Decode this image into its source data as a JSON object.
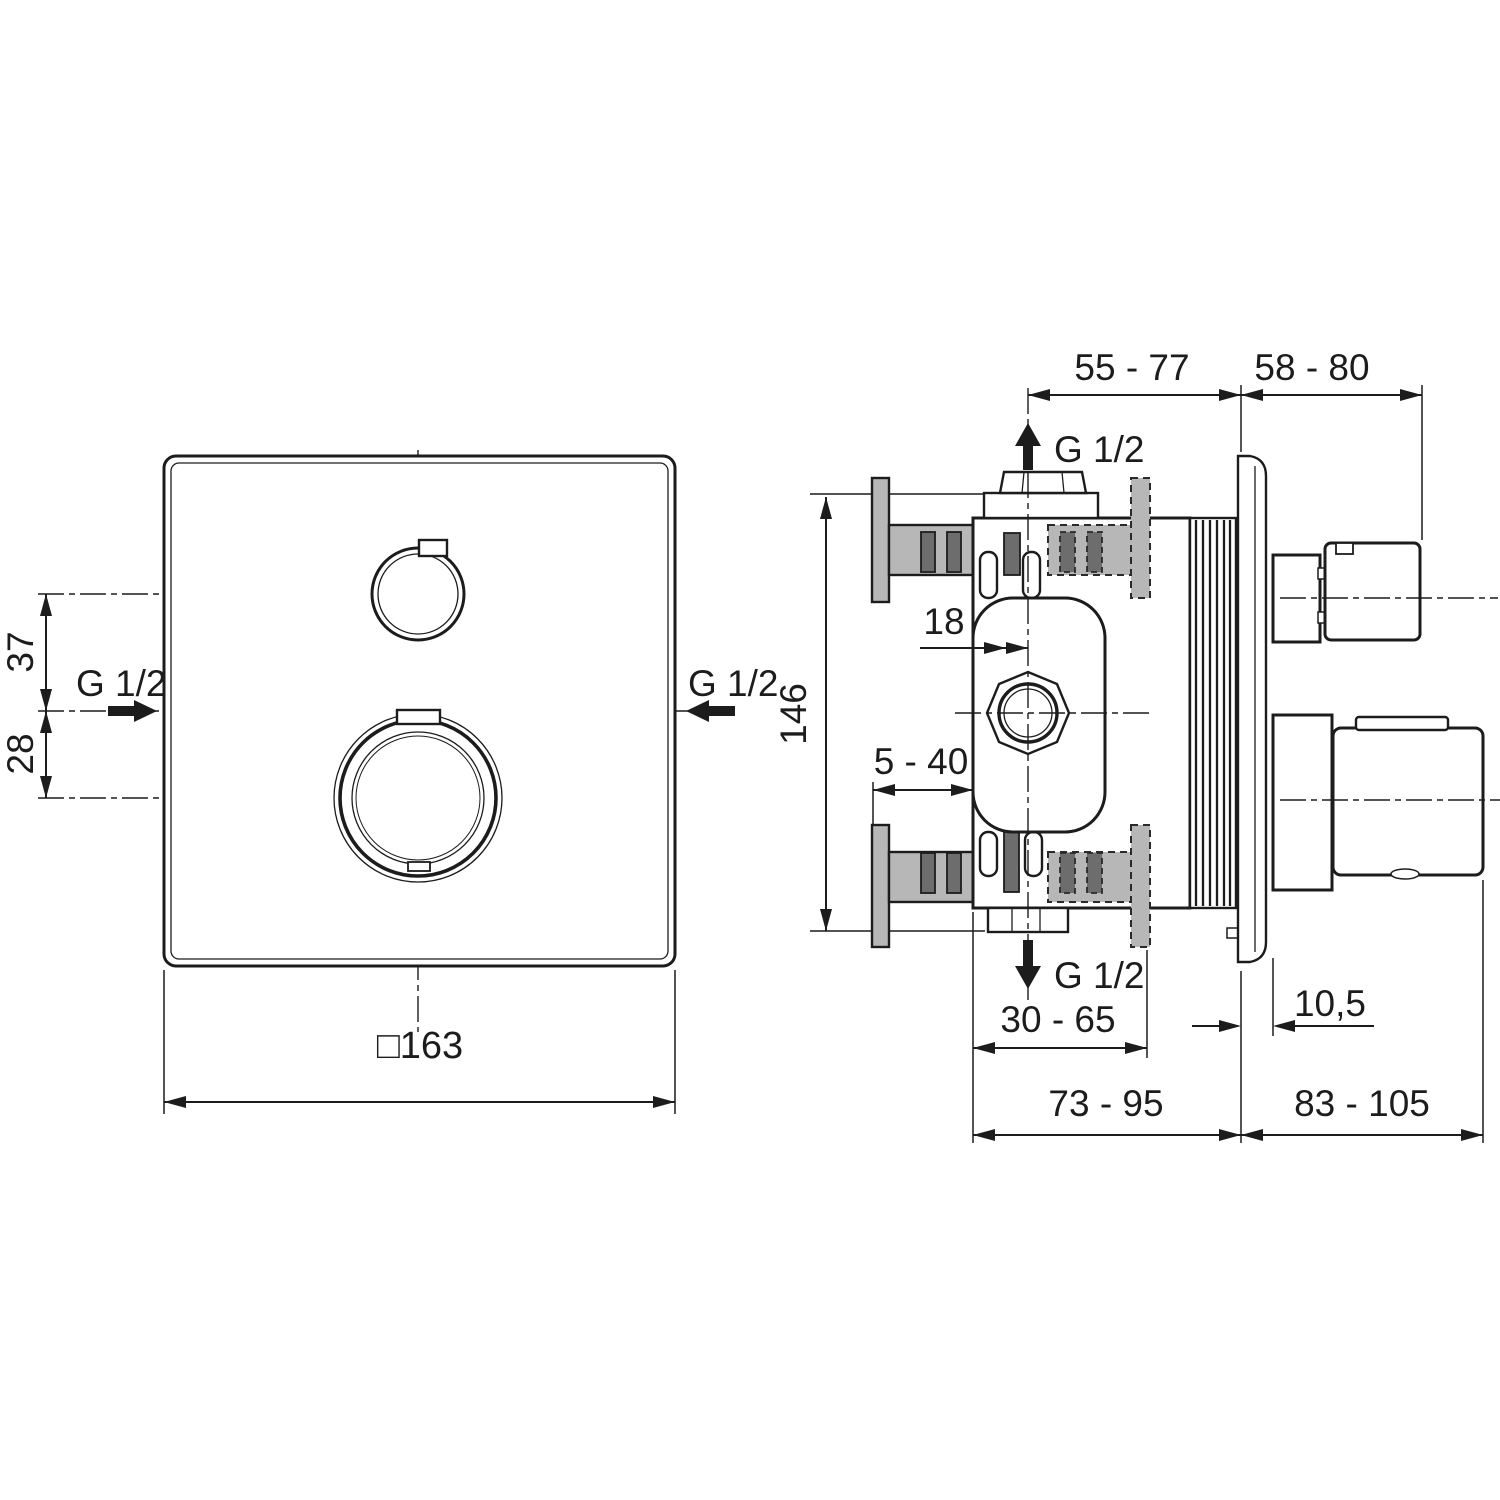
{
  "page": {
    "background": "#ffffff",
    "line_color": "#1c1c1c",
    "bracket_fill": "#b7b7b7",
    "slot_fill": "#6d6d6d"
  },
  "front_view": {
    "plate_width_label": "□163",
    "upper_knob_offset_label": "37",
    "inlet_offset_label": "28",
    "left_inlet_label": "G 1/2",
    "right_inlet_label": "G 1/2"
  },
  "side_view": {
    "top_outlet_label": "G 1/2",
    "bottom_outlet_label": "G 1/2",
    "height_label": "146",
    "center_offset_label": "18",
    "plaster_depth_label": "5 - 40",
    "rough_in_depth_label": "55 - 77",
    "trim_depth_label": "58 - 80",
    "body_depth_label": "30 - 65",
    "plate_offset_label": "10,5",
    "total_rough_depth_label": "73 - 95",
    "total_trim_depth_label": "83 - 105"
  }
}
